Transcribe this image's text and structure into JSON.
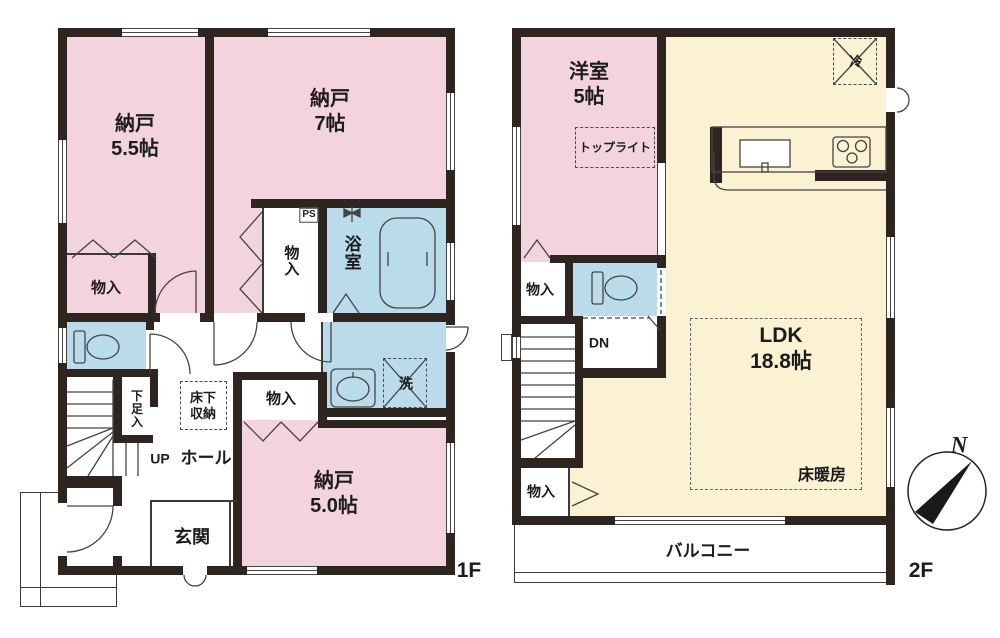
{
  "title": "間取り図",
  "colors": {
    "wall": "#2f2520",
    "pink": "#f3d3de",
    "blue": "#badcea",
    "cream": "#fbf1d3",
    "line": "#3a3a3a"
  },
  "floor1": {
    "label": "1F",
    "stairs_up": "UP",
    "hall": "ホール",
    "rooms": {
      "nando55": {
        "name": "納戸",
        "size": "5.5帖"
      },
      "nando7": {
        "name": "納戸",
        "size": "7帖"
      },
      "nando50": {
        "name": "納戸",
        "size": "5.0帖"
      },
      "bath": "浴室",
      "genkan": "玄関",
      "closet_a": "物入",
      "closet_b": "物入",
      "closet_c": "物入",
      "ps": "PS",
      "shoe_closet": "下足入",
      "underfloor_line1": "床下",
      "underfloor_line2": "収納",
      "laundry": "洗"
    }
  },
  "floor2": {
    "label": "2F",
    "compass_north": "N",
    "stairs_down": "DN",
    "rooms": {
      "yoshitsu": {
        "name": "洋室",
        "size": "5帖"
      },
      "ldk": {
        "name": "LDK",
        "size": "18.8帖"
      },
      "toplight": "トップライト",
      "fridge": "冷",
      "closet_a": "物入",
      "closet_b": "物入",
      "floor_heating": "床暖房",
      "balcony": "バルコニー"
    }
  }
}
